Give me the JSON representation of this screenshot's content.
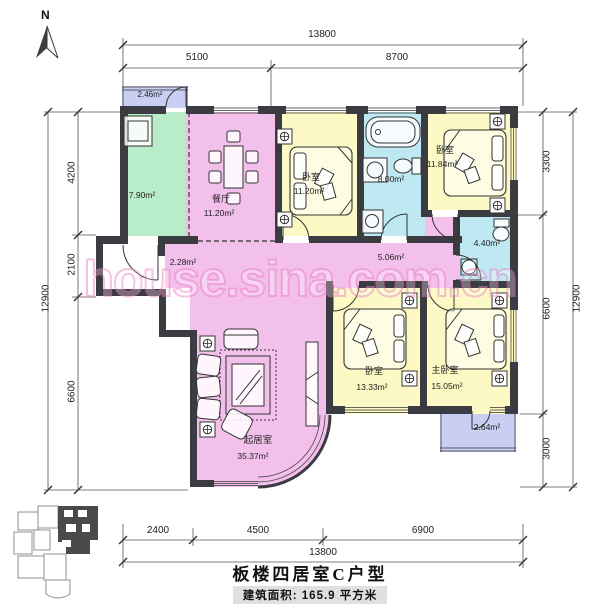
{
  "north": {
    "label": "N"
  },
  "watermark": {
    "text": "house.sina.com.cn"
  },
  "footer": {
    "title": "板楼四居室C户型",
    "area_line": "建筑面积: 165.9 平方米"
  },
  "dimensions": {
    "top": {
      "total": "13800",
      "seg1": "5100",
      "seg2": "8700"
    },
    "bottom": {
      "total": "13800",
      "seg1": "2400",
      "seg2": "4500",
      "seg3": "6900"
    },
    "left": {
      "total": "12900",
      "seg1": "4200",
      "seg2": "2100",
      "seg3": "6600"
    },
    "right": {
      "total": "12900",
      "seg1": "3300",
      "seg2": "6600",
      "seg3": "3000"
    }
  },
  "rooms": {
    "balcony_top": {
      "area": "2.46m²"
    },
    "kitchen": {
      "area": "7.90m²"
    },
    "dining": {
      "name": "餐厅",
      "area": "11.20m²"
    },
    "bedroom_mid": {
      "name": "卧室",
      "area": "11.20m²"
    },
    "bathroom_main": {
      "area": "8.00m²"
    },
    "bedroom_ne": {
      "name": "卧室",
      "area": "11.84m²"
    },
    "bathroom_small": {
      "area": "4.40m²"
    },
    "hallway": {
      "area": "5.06m²"
    },
    "entry": {
      "area": "2.28m²"
    },
    "living": {
      "name": "起居室",
      "area": "35.37m²"
    },
    "bedroom_s": {
      "name": "卧室",
      "area": "13.33m²"
    },
    "master": {
      "name": "主卧室",
      "area": "15.05m²"
    },
    "balcony_bottom": {
      "area": "2.64m²"
    }
  },
  "colors": {
    "wall": "#3b3b42",
    "pink": "#f3c0ec",
    "yellow": "#fcf9c4",
    "cyan": "#bfe9f2",
    "green": "#b9ecc9",
    "lavender": "#c9cff2",
    "watermark": "#ec86c4"
  }
}
